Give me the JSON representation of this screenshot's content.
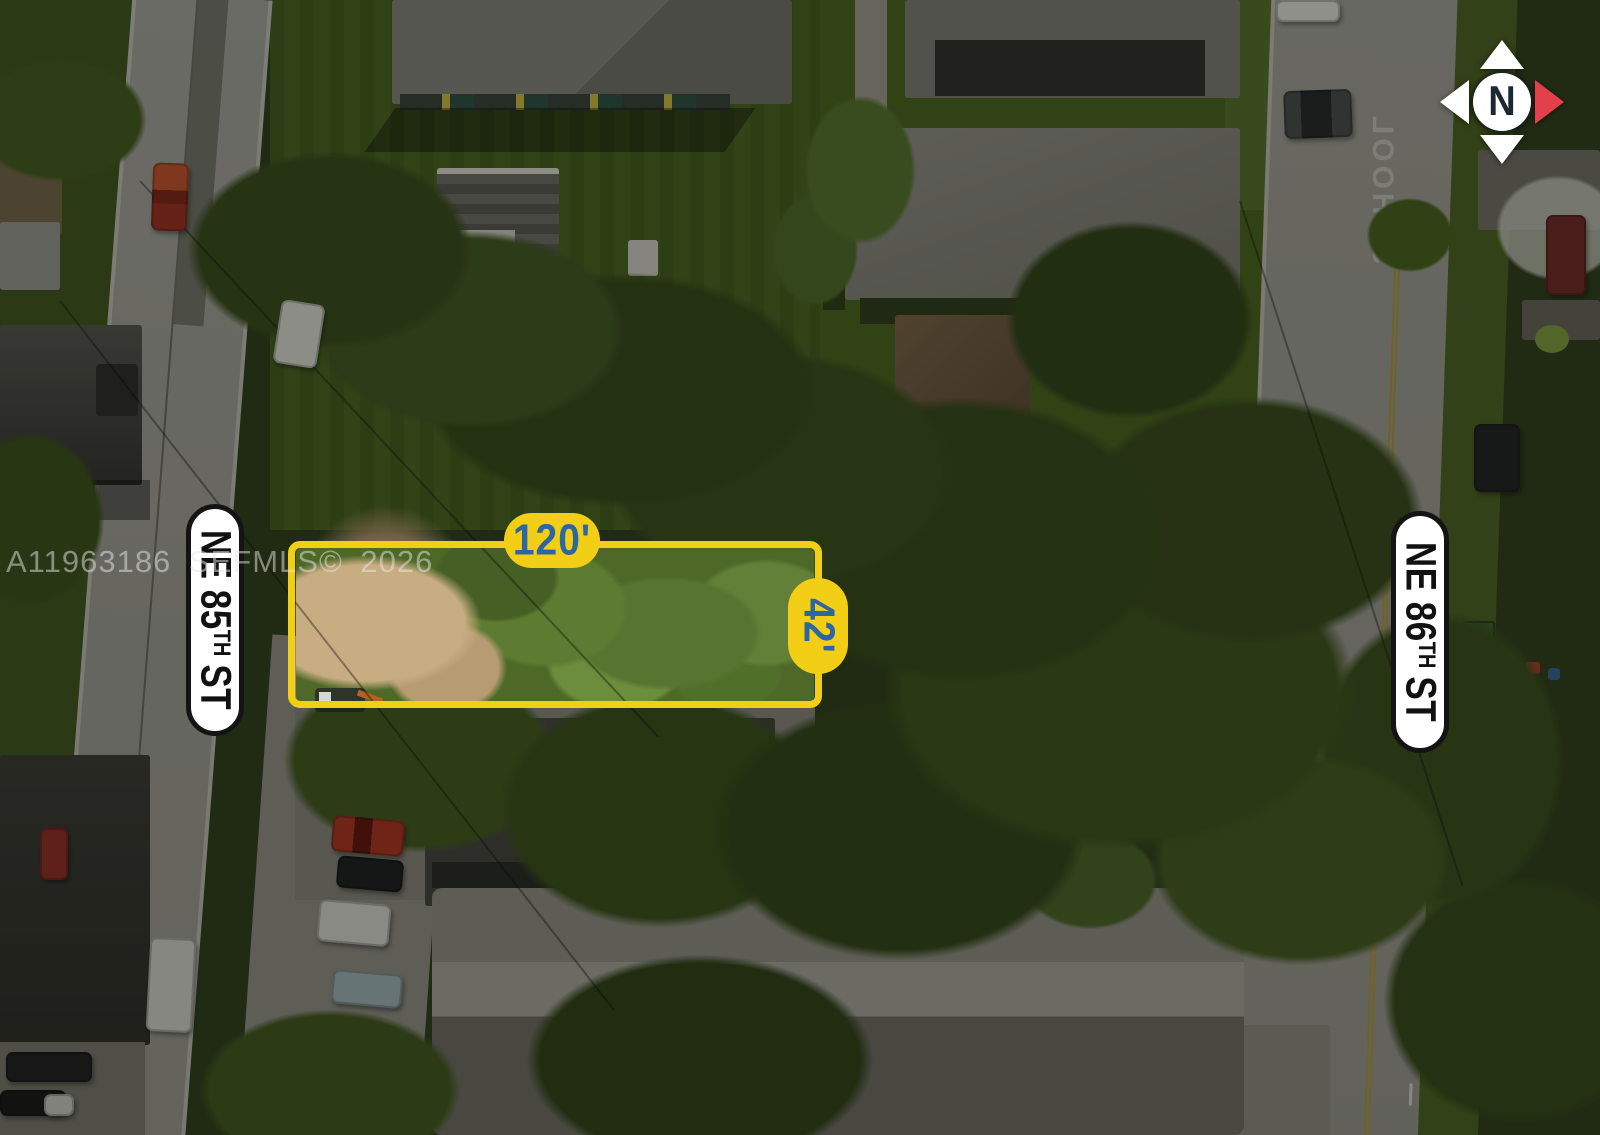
{
  "annotations": {
    "watermark_text": "A11963186 SEFMLS© 2026",
    "lot_width_label": "120'",
    "lot_depth_label": "42'",
    "street_labels": [
      {
        "pre": "NE 85",
        "ordinal": "TH",
        "post": "ST"
      },
      {
        "pre": "NE 86",
        "ordinal": "TH",
        "post": "ST"
      }
    ],
    "compass_letter": "N",
    "road_marking": "SCHOOL"
  },
  "colors": {
    "annotation_yellow": "#F2CF16",
    "annotation_blue": "#2C67A3",
    "compass_red": "#E4404B",
    "street_pill_bg": "#FFFFFF",
    "street_pill_border": "#141414"
  }
}
